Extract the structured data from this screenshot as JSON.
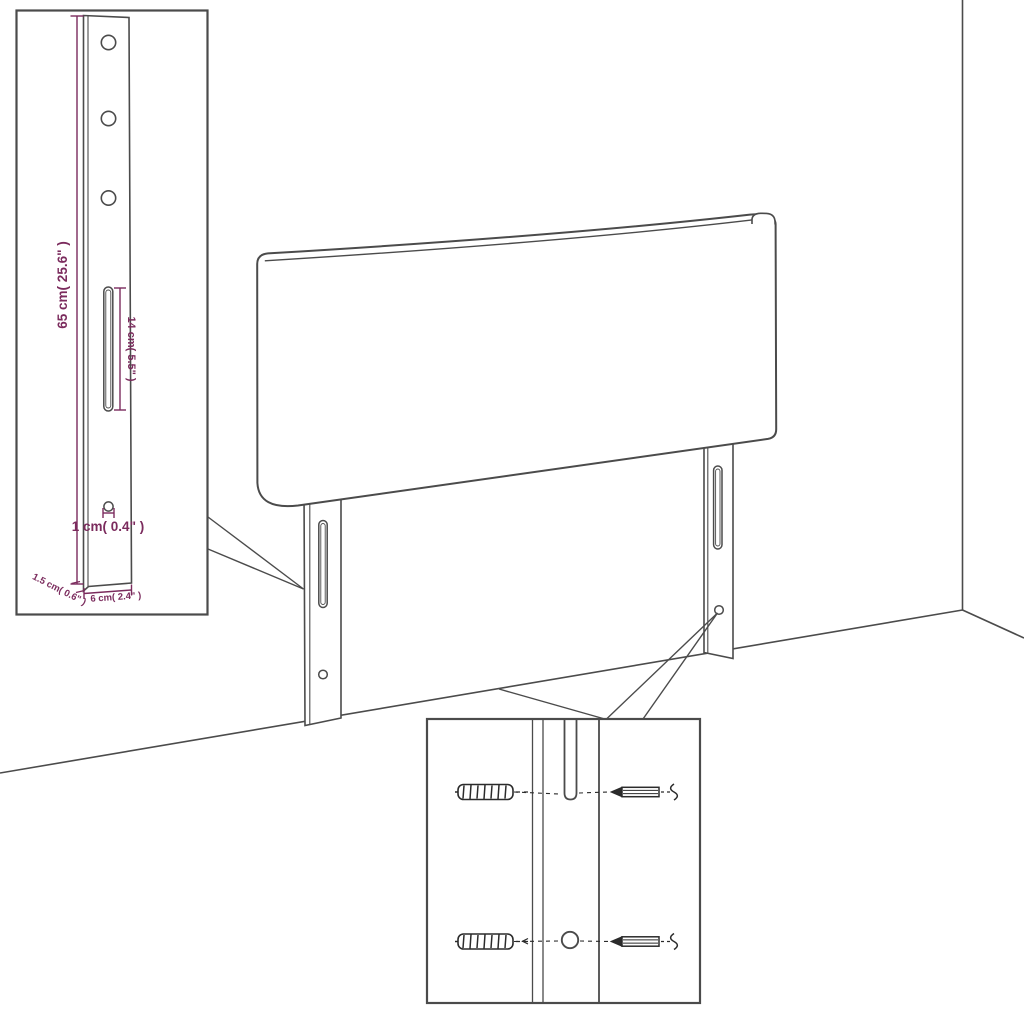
{
  "diagram": {
    "kind": "headboard-assembly-dimension-diagram",
    "background": "#ffffff",
    "line_color": "#4b4b4b",
    "dimension_color": "#7b2b5d",
    "scene": {
      "panel": "upholstered headboard panel against wall corner",
      "leg_count": 2
    },
    "leg_detail_callout": {
      "height_label": "65 cm( 25.6\" )",
      "slot_length_label": "14 cm( 5.5\" )",
      "hole_diameter_label": "1 cm( 0.4\" )",
      "thickness_label": "1.5 cm( 0.6\" )",
      "width_label": "6 cm( 2.4\" )",
      "top_hole_count": 3
    },
    "hardware_detail_callout": {
      "rows": 2,
      "left_icon": "wall-plug-icon",
      "right_icon": "screw-icon"
    }
  }
}
